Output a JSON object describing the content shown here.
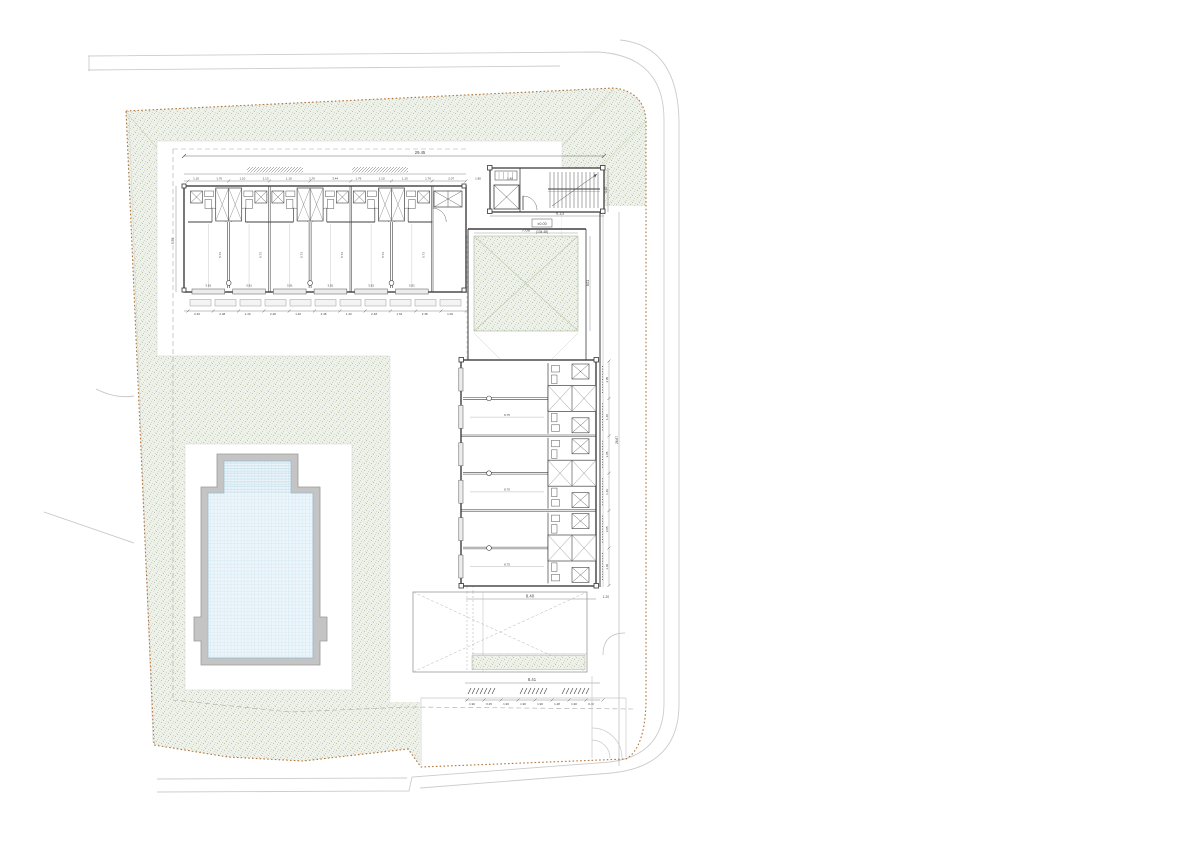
{
  "annotations": {
    "overall_width": "29.45",
    "stair_width": "6.13",
    "stair_height": "3.40",
    "level_box": "±0.00",
    "level_area": "(134.48)",
    "courtyard_width": "7.00",
    "courtyard_height": "8.01",
    "wing_bottom_width": "8.40",
    "wing_bottom_side": "1.20",
    "canopy_width": "8.41",
    "right_overall": "26.67",
    "left_wing_depth": "5.75",
    "room_depth": "5.73",
    "room_width": "3.81",
    "right_room_width": "8.75",
    "top_dims": [
      "1.10",
      "1.76",
      "1.10",
      "1.13",
      "1.10",
      "1.76",
      "3.44",
      "1.76",
      "1.10",
      "1.13",
      "1.76",
      "2.07"
    ],
    "extra_top_dims": [
      "1.80",
      "1.40"
    ],
    "top_bottom_dims": [
      "0.40",
      "2.48",
      "1.40",
      "2.48",
      "1.40",
      "2.48",
      "1.40",
      "2.48",
      "1.64",
      "2.48",
      "1.09"
    ],
    "canopy_dims": [
      "1.90",
      "0.45",
      "1.90",
      "1.90",
      "1.90",
      "1.28",
      "1.90",
      "0.40"
    ],
    "right_dims": [
      "3.05",
      "1.40",
      "3.05",
      "1.40",
      "3.05",
      "1.40"
    ]
  },
  "structure": {
    "top_wing_units": 6,
    "right_wing_units": 6,
    "stair_treads": 13,
    "terrace_planks": 11
  },
  "colors": {
    "lawn_base": "#eef1e9",
    "lawn_dot": "#bac8ad",
    "pool_water": "#ebf5fa",
    "pool_grid": "#c2dcec",
    "pool_coping": "#c4c4c4",
    "boundary": "#b0753c",
    "road": "#cccccc",
    "wall": "#3f3f3f",
    "dim_text": "#444444"
  }
}
